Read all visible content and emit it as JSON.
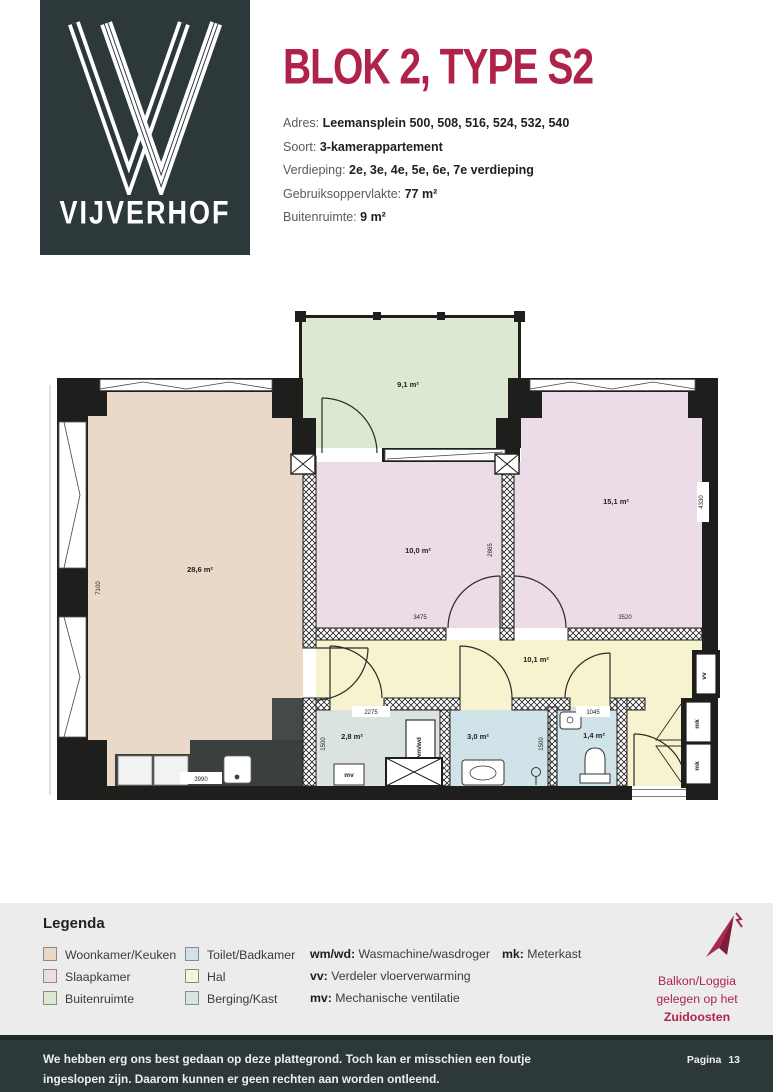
{
  "colors": {
    "accent": "#b02349",
    "dark": "#2d383a",
    "living": "#ead9c8",
    "bedroom": "#ecdce8",
    "outdoor": "#dde8d2",
    "wet": "#d0e3e9",
    "hall": "#f8f3cf",
    "storage": "#dbe3df"
  },
  "header": {
    "logo_text": "VIJVERHOF",
    "title": "BLOK 2, TYPE S2",
    "info": [
      {
        "label": "Adres:",
        "value": "Leemansplein 500, 508, 516, 524, 532, 540"
      },
      {
        "label": "Soort:",
        "value": "3-kamerappartement"
      },
      {
        "label": "Verdieping:",
        "value": "2e, 3e, 4e, 5e, 6e, 7e verdieping"
      },
      {
        "label": "Gebruiksoppervlakte:",
        "value": "77 m²"
      },
      {
        "label": "Buitenruimte:",
        "value": "9 m²"
      }
    ]
  },
  "plan": {
    "rooms": {
      "living": {
        "name": "Woonkamer/Keuken",
        "area": "28,6 m²"
      },
      "balcony": {
        "name": "Buitenruimte",
        "area": "9,1 m²"
      },
      "bedroom1": {
        "name": "Slaapkamer",
        "area": "10,0 m²"
      },
      "bedroom2": {
        "name": "Slaapkamer",
        "area": "15,1 m²"
      },
      "hall": {
        "name": "Hal",
        "area": "10,1 m²"
      },
      "storage": {
        "name": "Berging/Kast",
        "area": "2,8 m²"
      },
      "bathroom": {
        "name": "Toilet/Badkamer",
        "area": "3,0 m²"
      },
      "toilet": {
        "name": "Toilet",
        "area": "1,4 m²"
      }
    },
    "dims": {
      "living_h": "7100",
      "kitchen_w": "3990",
      "storage_w": "2275",
      "storage_h": "1500",
      "bathroom_h": "1500",
      "toilet_w": "1045",
      "bedroom1_w": "3475",
      "bedroom1_h": "2865",
      "bedroom2_w": "3520",
      "bedroom2_h": "4330"
    },
    "fixtures": {
      "wmwd": "wm/wd",
      "mv": "mv",
      "vv": "vv",
      "mk": "mk"
    }
  },
  "legend": {
    "title": "Legenda",
    "col1": [
      {
        "label": "Woonkamer/Keuken"
      },
      {
        "label": "Slaapkamer"
      },
      {
        "label": "Buitenruimte"
      }
    ],
    "col2": [
      {
        "label": "Toilet/Badkamer"
      },
      {
        "label": "Hal"
      },
      {
        "label": "Berging/Kast"
      }
    ],
    "abbr": [
      {
        "key": "wm/wd:",
        "label": "Wasmachine/wasdroger"
      },
      {
        "key": "vv:",
        "label": "Verdeler vloerverwarming"
      },
      {
        "key": "mv:",
        "label": "Mechanische ventilatie"
      }
    ],
    "abbr2": [
      {
        "key": "mk:",
        "label": "Meterkast"
      }
    ]
  },
  "compass": {
    "line1": "Balkon/Loggia",
    "line2": "gelegen op het",
    "line3": "Zuidoosten"
  },
  "footer": {
    "line1": "We hebben erg ons best gedaan op deze plattegrond. Toch kan er misschien een foutje",
    "line2": "ingeslopen zijn. Daarom kunnen er geen rechten aan worden ontleend.",
    "page_label": "Pagina",
    "page_number": "13"
  }
}
